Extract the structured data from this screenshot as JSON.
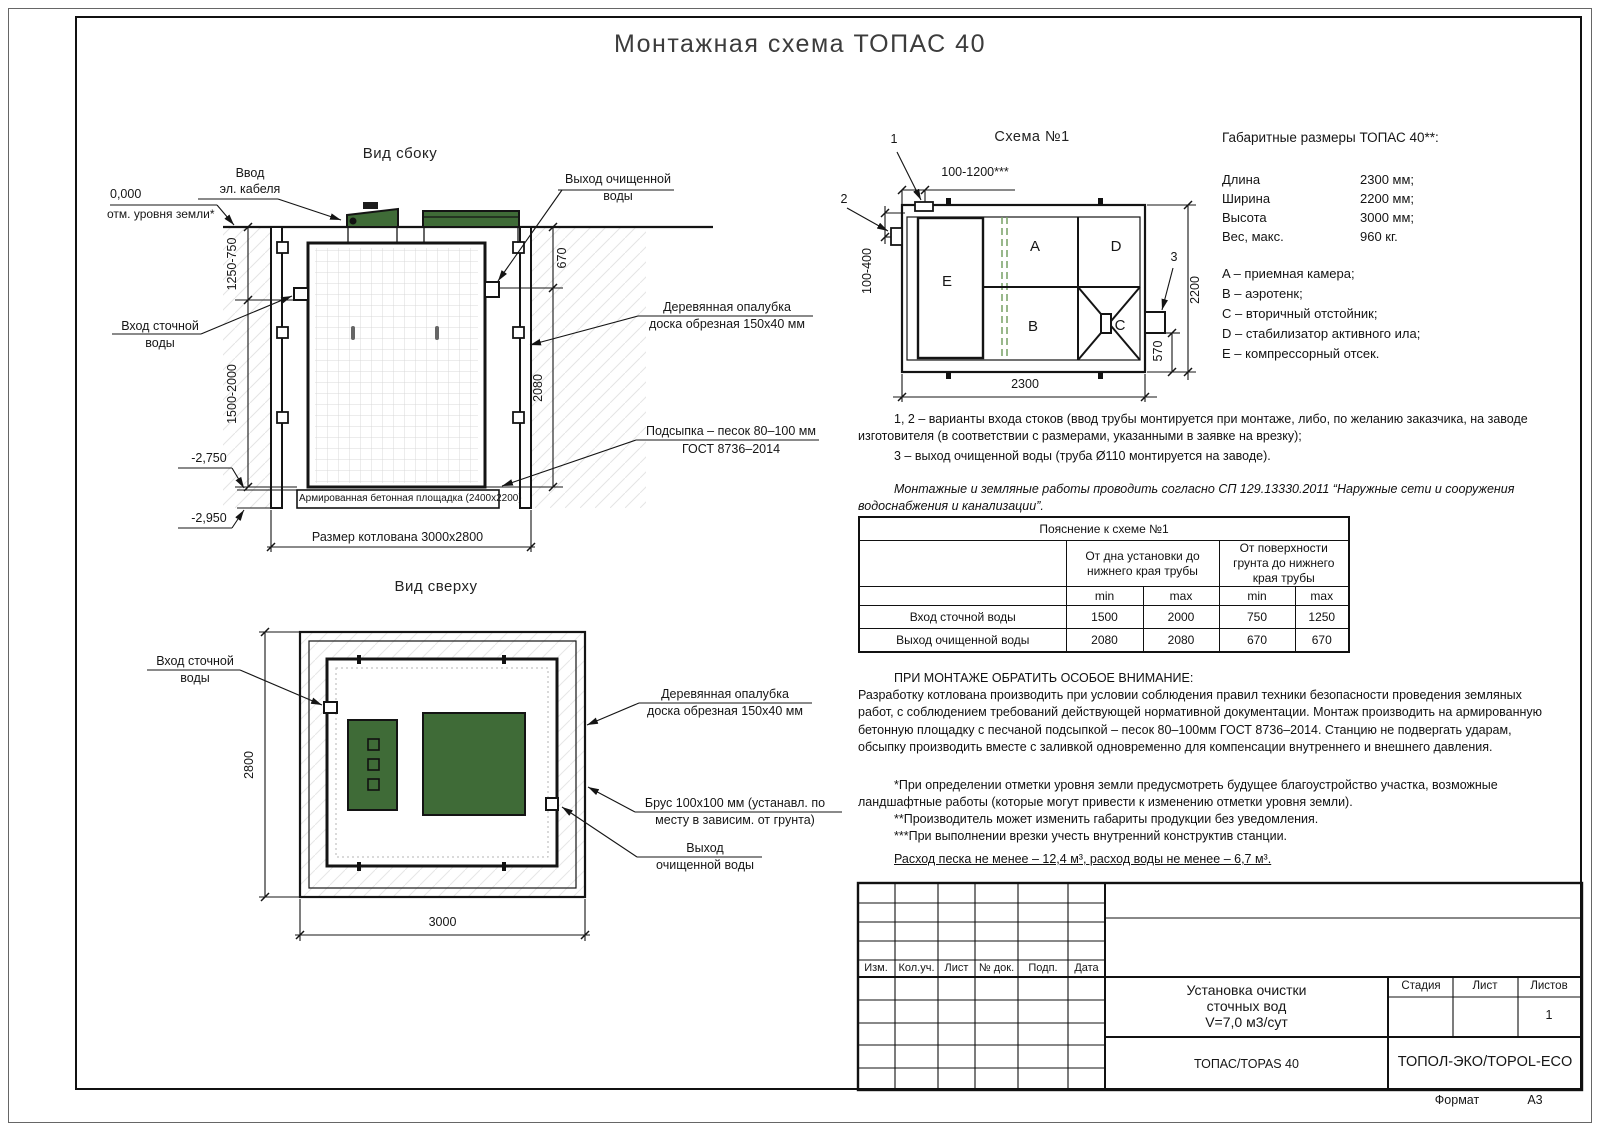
{
  "doc": {
    "title": "Монтажная схема ТОПАС 40",
    "format_label": "Формат",
    "format_value": "А3"
  },
  "side_view": {
    "title": "Вид сбоку",
    "zero_mark": "0,000",
    "zero_note": "отм. уровня земли*",
    "cable_l1": "Ввод",
    "cable_l2": "эл. кабеля",
    "outlet_l1": "Выход очищенной",
    "outlet_l2": "воды",
    "inlet_l1": "Вход сточной",
    "inlet_l2": "воды",
    "dim_upper": "1250-750",
    "dim_lower": "1500-2000",
    "dim_out": "670",
    "dim_bottom": "2080",
    "formwork_l1": "Деревянная опалубка",
    "formwork_l2": "доска обрезная 150x40 мм",
    "bedding_l1": "Подсыпка – песок 80–100 мм",
    "bedding_l2": "ГОСТ 8736–2014",
    "slab": "Армированная бетонная площадка (2400x2200)",
    "level_1": "-2,750",
    "level_2": "-2,950",
    "pit_size": "Размер котлована 3000x2800"
  },
  "top_view": {
    "title": "Вид сверху",
    "inlet_l1": "Вход сточной",
    "inlet_l2": "воды",
    "dim_w": "2800",
    "dim_l": "3000",
    "formwork_l1": "Деревянная опалубка",
    "formwork_l2": "доска обрезная 150x40 мм",
    "beam_l1": "Брус 100x100 мм (устанавл. по",
    "beam_l2": "месту в зависим. от грунта)",
    "outlet_l1": "Выход",
    "outlet_l2": "очищенной воды"
  },
  "schema": {
    "title": "Схема №1",
    "c1": "1",
    "c2": "2",
    "c3": "3",
    "dim_inlet": "100-1200***",
    "dim_side": "100-400",
    "dim_len": "2300",
    "dim_wid": "2200",
    "dim_out": "570",
    "A": "A",
    "B": "B",
    "C": "C",
    "D": "D",
    "E": "E"
  },
  "specs": {
    "heading": "Габаритные размеры ТОПАС 40**:",
    "rows": [
      {
        "label": "Длина",
        "value": "2300 мм;"
      },
      {
        "label": "Ширина",
        "value": "2200 мм;"
      },
      {
        "label": "Высота",
        "value": "3000 мм;"
      },
      {
        "label": "Вес, макс.",
        "value": "960 кг."
      }
    ],
    "legend": [
      "A – приемная камера;",
      "B – аэротенк;",
      "C – вторичный отстойник;",
      "D – стабилизатор активного ила;",
      "E – компрессорный отсек."
    ]
  },
  "notes": {
    "variants": "1, 2 – варианты входа  стоков (ввод трубы монтируется при монтаже, либо, по желанию заказчика, на заводе изготовителя (в соответствии с размерами, указанными в заявке на врезку);",
    "outlet": "3 – выход очищенной воды (труба Ø110 монтируется на заводе).",
    "sp": "Монтажные и земляные работы проводить согласно СП 129.13330.2011 “Наружные сети и сооружения водоснабжения и канализации”.",
    "attention_title": "ПРИ МОНТАЖЕ ОБРАТИТЬ ОСОБОЕ ВНИМАНИЕ:",
    "attention_body": "Разработку котлована производить при условии соблюдения правил техники безопасности проведения земляных работ, с соблюдением требований действующей нормативной документации.  Монтаж производить на армированную бетонную площадку с песчаной подсыпкой – песок 80–100мм ГОСТ 8736–2014. Станцию не подвергать ударам, обсыпку производить вместе с заливкой одновременно для компенсации внутреннего и внешнего давления.",
    "star1": "*При определении отметки уровня земли предусмотреть будущее благоустройство участка, возможные ландшафтные работы (которые могут привести к изменению отметки уровня земли).",
    "star2": "**Производитель может изменить габариты продукции без уведомления.",
    "star3": "***При выполнении врезки учесть внутренний конструктив станции.",
    "consumption": "Расход песка не менее – 12,4 м³, расход воды не менее – 6,7 м³."
  },
  "table": {
    "title": "Пояснение к схеме №1",
    "group1": "От дна установки до нижнего края трубы",
    "group2": "От поверхности грунта до нижнего края трубы",
    "min": "min",
    "max": "max",
    "rows": [
      {
        "label": "Вход сточной воды",
        "v1": "1500",
        "v2": "2000",
        "v3": "750",
        "v4": "1250"
      },
      {
        "label": "Выход очищенной воды",
        "v1": "2080",
        "v2": "2080",
        "v3": "670",
        "v4": "670"
      }
    ]
  },
  "stamp": {
    "cols": [
      "Изм.",
      "Кол.уч.",
      "Лист",
      "№ док.",
      "Подп.",
      "Дата"
    ],
    "doc_l1": "Установка очистки",
    "doc_l2": "сточных вод",
    "doc_l3": "V=7,0 м3/сут",
    "product": "ТОПАС/TOPAS 40",
    "company": "ТОПОЛ-ЭКО/TOPOL-ECO",
    "stage": "Стадия",
    "sheet": "Лист",
    "sheets": "Листов",
    "sheets_value": "1"
  },
  "colors": {
    "lid_green": "#3f6b37",
    "line": "#141414"
  }
}
